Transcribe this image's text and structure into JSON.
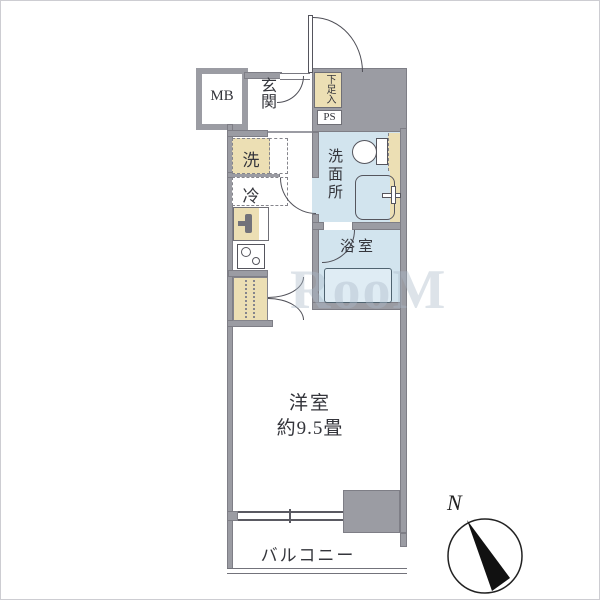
{
  "plan": {
    "title": "apartment floor plan",
    "watermark": "RooM",
    "rooms": {
      "mb": {
        "label": "MB"
      },
      "genkan": {
        "label": "玄関"
      },
      "shoe_box": {
        "label": "下足入"
      },
      "pipe_space": {
        "label": "PS"
      },
      "washer": {
        "label": "洗"
      },
      "fridge": {
        "label": "冷"
      },
      "washroom": {
        "label": "洗面所"
      },
      "bathroom": {
        "label": "浴室"
      },
      "main_room": {
        "label": "洋室",
        "size": "約9.5畳"
      },
      "balcony": {
        "label": "バルコニー"
      }
    },
    "compass": {
      "label": "N"
    },
    "colors": {
      "wall_gray": "#9b9ca3",
      "fixture_beige": "#ecdfb4",
      "water_blue": "#d2e4ee",
      "line": "#4f4f57"
    }
  }
}
